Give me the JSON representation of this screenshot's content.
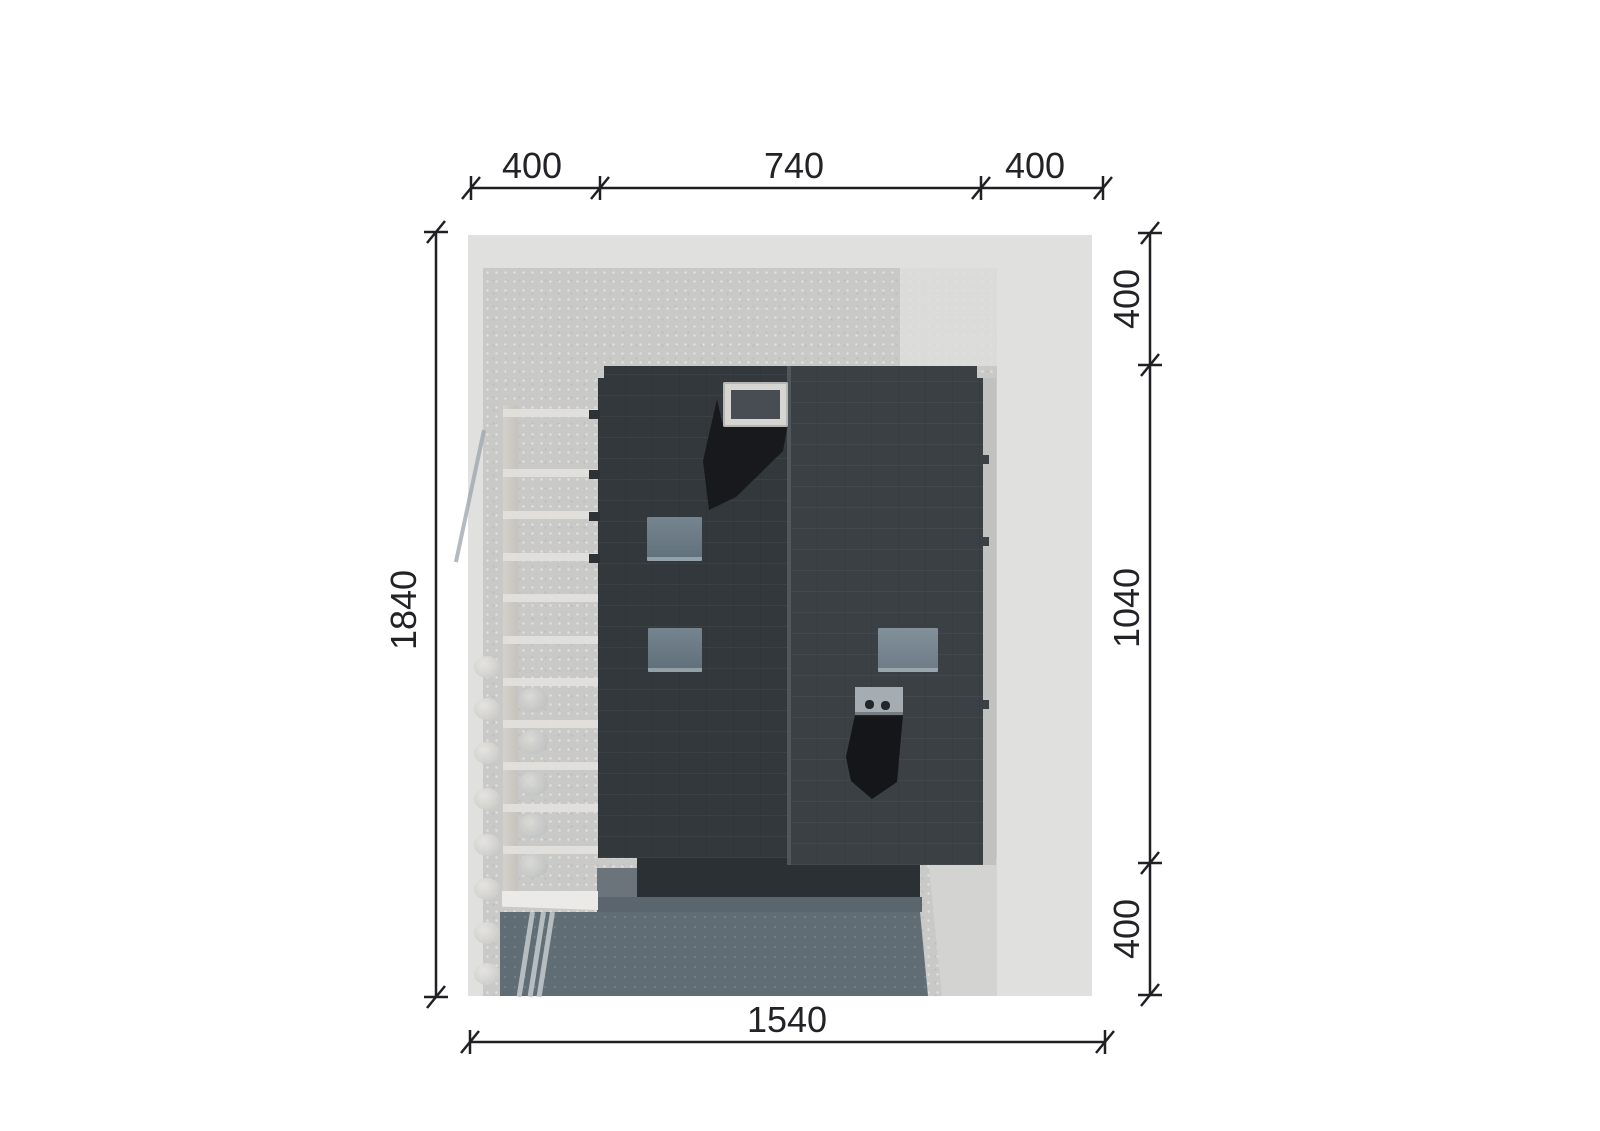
{
  "drawing": {
    "type": "architectural roof plan with dimensions",
    "dimensions": {
      "top": {
        "segments": [
          {
            "value": "400"
          },
          {
            "value": "740"
          },
          {
            "value": "400"
          }
        ]
      },
      "right": {
        "segments": [
          {
            "value": "400"
          },
          {
            "value": "1040"
          },
          {
            "value": "400"
          }
        ]
      },
      "left": {
        "total": {
          "value": "1840"
        }
      },
      "bottom": {
        "total": {
          "value": "1540"
        }
      }
    },
    "palette": {
      "page_background": "#ffffff",
      "site_ground": "#e0e0df",
      "concrete_pad": "#c9c9c8",
      "roof_dark": "#33383c",
      "roof_light": "#3a4044",
      "shadow_blue": "#5f6b73",
      "shadow_black": "#16181c",
      "skylight_blue": "#71808b",
      "pergola_white": "#e9e7e3",
      "dimension_line": "#202024"
    }
  }
}
